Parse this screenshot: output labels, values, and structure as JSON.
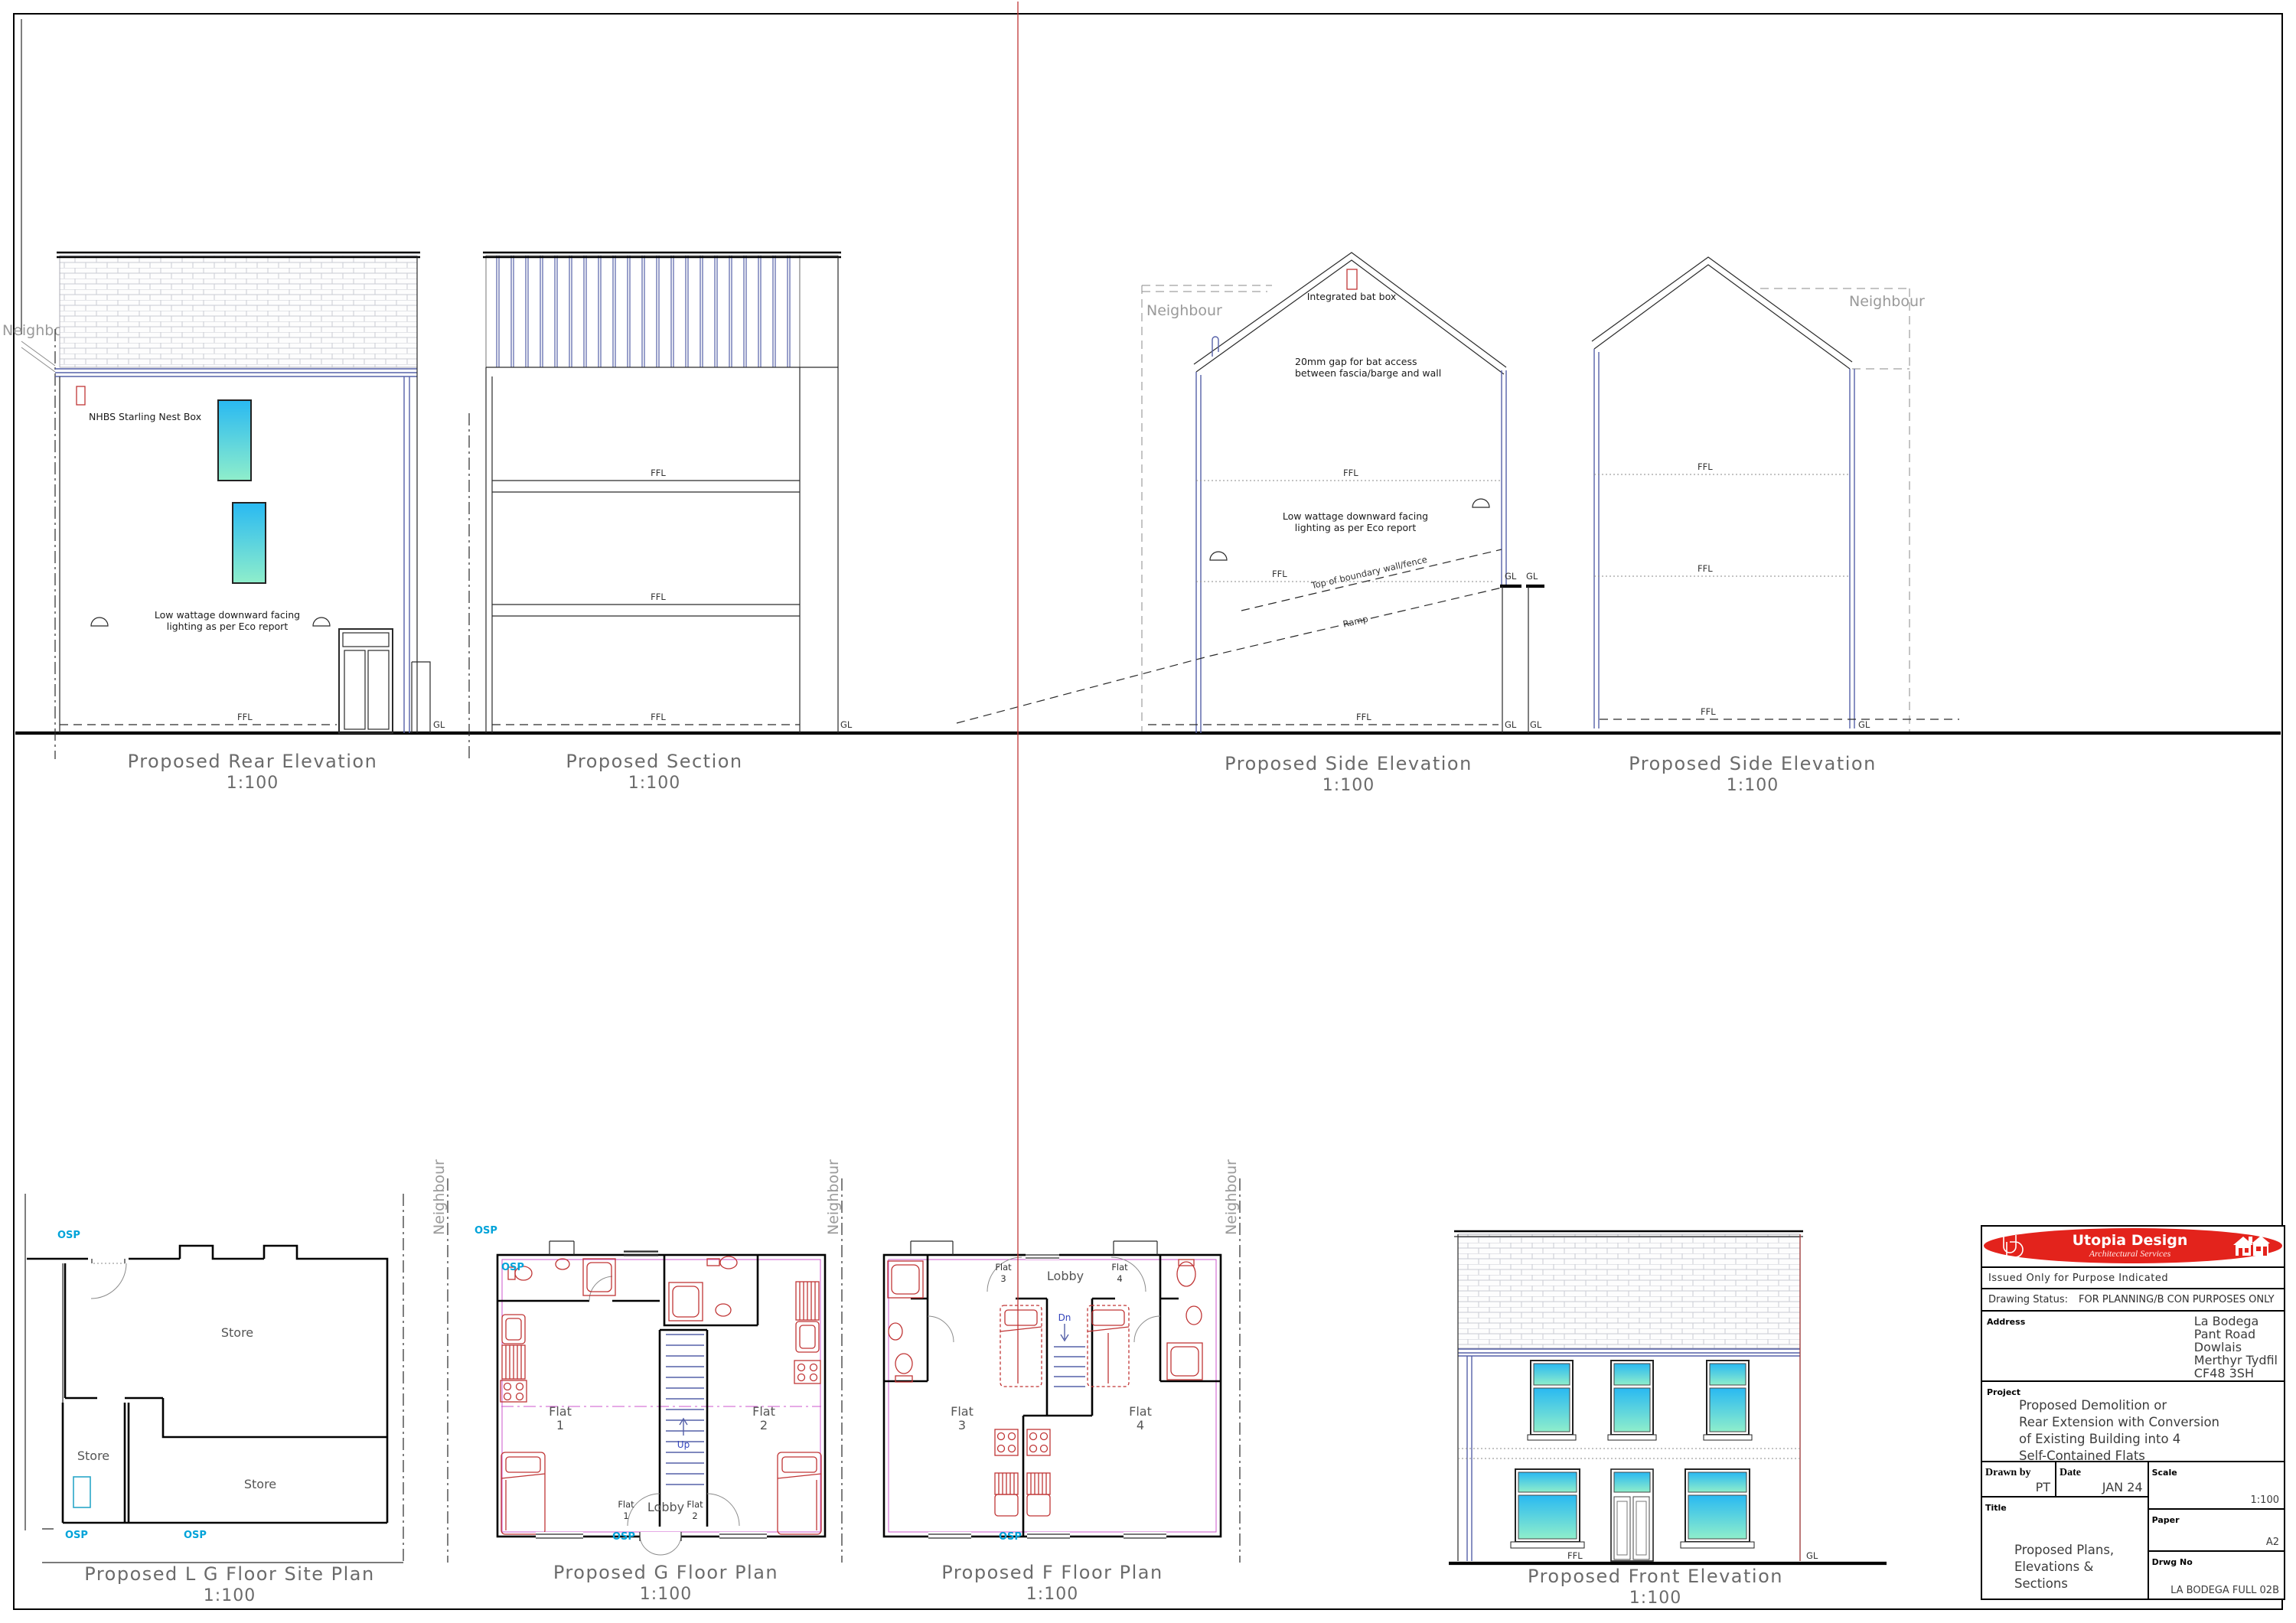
{
  "labels": {
    "ffl": "FFL",
    "gl": "GL",
    "neighbour": "Neighbour",
    "osp": "OSP",
    "lobby": "Lobby",
    "store": "Store",
    "flat": "Flat",
    "up": "Up",
    "dn": "Dn",
    "scale": "1:100",
    "light1": "Low wattage downward facing",
    "light2": "lighting as per Eco report"
  },
  "drawings": {
    "rear": {
      "title": "Proposed Rear Elevation",
      "nest_box": "NHBS Starling Nest Box"
    },
    "section": {
      "title": "Proposed Section"
    },
    "side1": {
      "title": "Proposed Side Elevation",
      "bat_box": "Integrated bat box",
      "bat_gap1": "20mm gap for bat access",
      "bat_gap2": "between fascia/barge and wall",
      "boundary": "Top of boundary wall/fence",
      "ramp": "Ramp"
    },
    "side2": {
      "title": "Proposed Side Elevation"
    },
    "site": {
      "title": "Proposed L G Floor Site Plan"
    },
    "gfloor": {
      "title": "Proposed G Floor Plan",
      "n1": "1",
      "n2": "2"
    },
    "ffloor": {
      "title": "Proposed F Floor Plan",
      "n3": "3",
      "n4": "4"
    },
    "front": {
      "title": "Proposed Front Elevation"
    }
  },
  "title_block": {
    "logo_monogram": "UD",
    "logo_title": "Utopia Design",
    "logo_subtitle": "Architectural Services",
    "issued": "Issued Only for Purpose Indicated",
    "status_label": "Drawing Status:",
    "status_value": "FOR PLANNING/B CON PURPOSES ONLY",
    "address_label": "Address",
    "address_lines": [
      "La Bodega",
      "Pant Road",
      "Dowlais",
      "Merthyr Tydfil",
      "CF48 3SH"
    ],
    "project_label": "Project",
    "project_lines": [
      "Proposed Demolition or",
      "Rear Extension with Conversion",
      "of Existing Building into 4",
      "Self-Contained Flats"
    ],
    "drawn_by_label": "Drawn by",
    "drawn_by": "PT",
    "date_label": "Date",
    "date": "JAN 24",
    "scale_label": "Scale",
    "scale": "1:100",
    "title_label": "Title",
    "title_lines": [
      "Proposed Plans,",
      "Elevations &",
      "Sections"
    ],
    "paper_label": "Paper",
    "paper": "A2",
    "drwg_label": "Drwg No",
    "drwg_no": "LA BODEGA FULL 02B"
  },
  "colors": {
    "window_top": "#29b9f2",
    "window_bottom": "#8feecb",
    "line_blue": "#5560a8",
    "fixture_red": "#c03535",
    "inner_magenta": "#cc55cc",
    "osp_cyan": "#00a3d9",
    "logo_red": "#e3231c"
  }
}
